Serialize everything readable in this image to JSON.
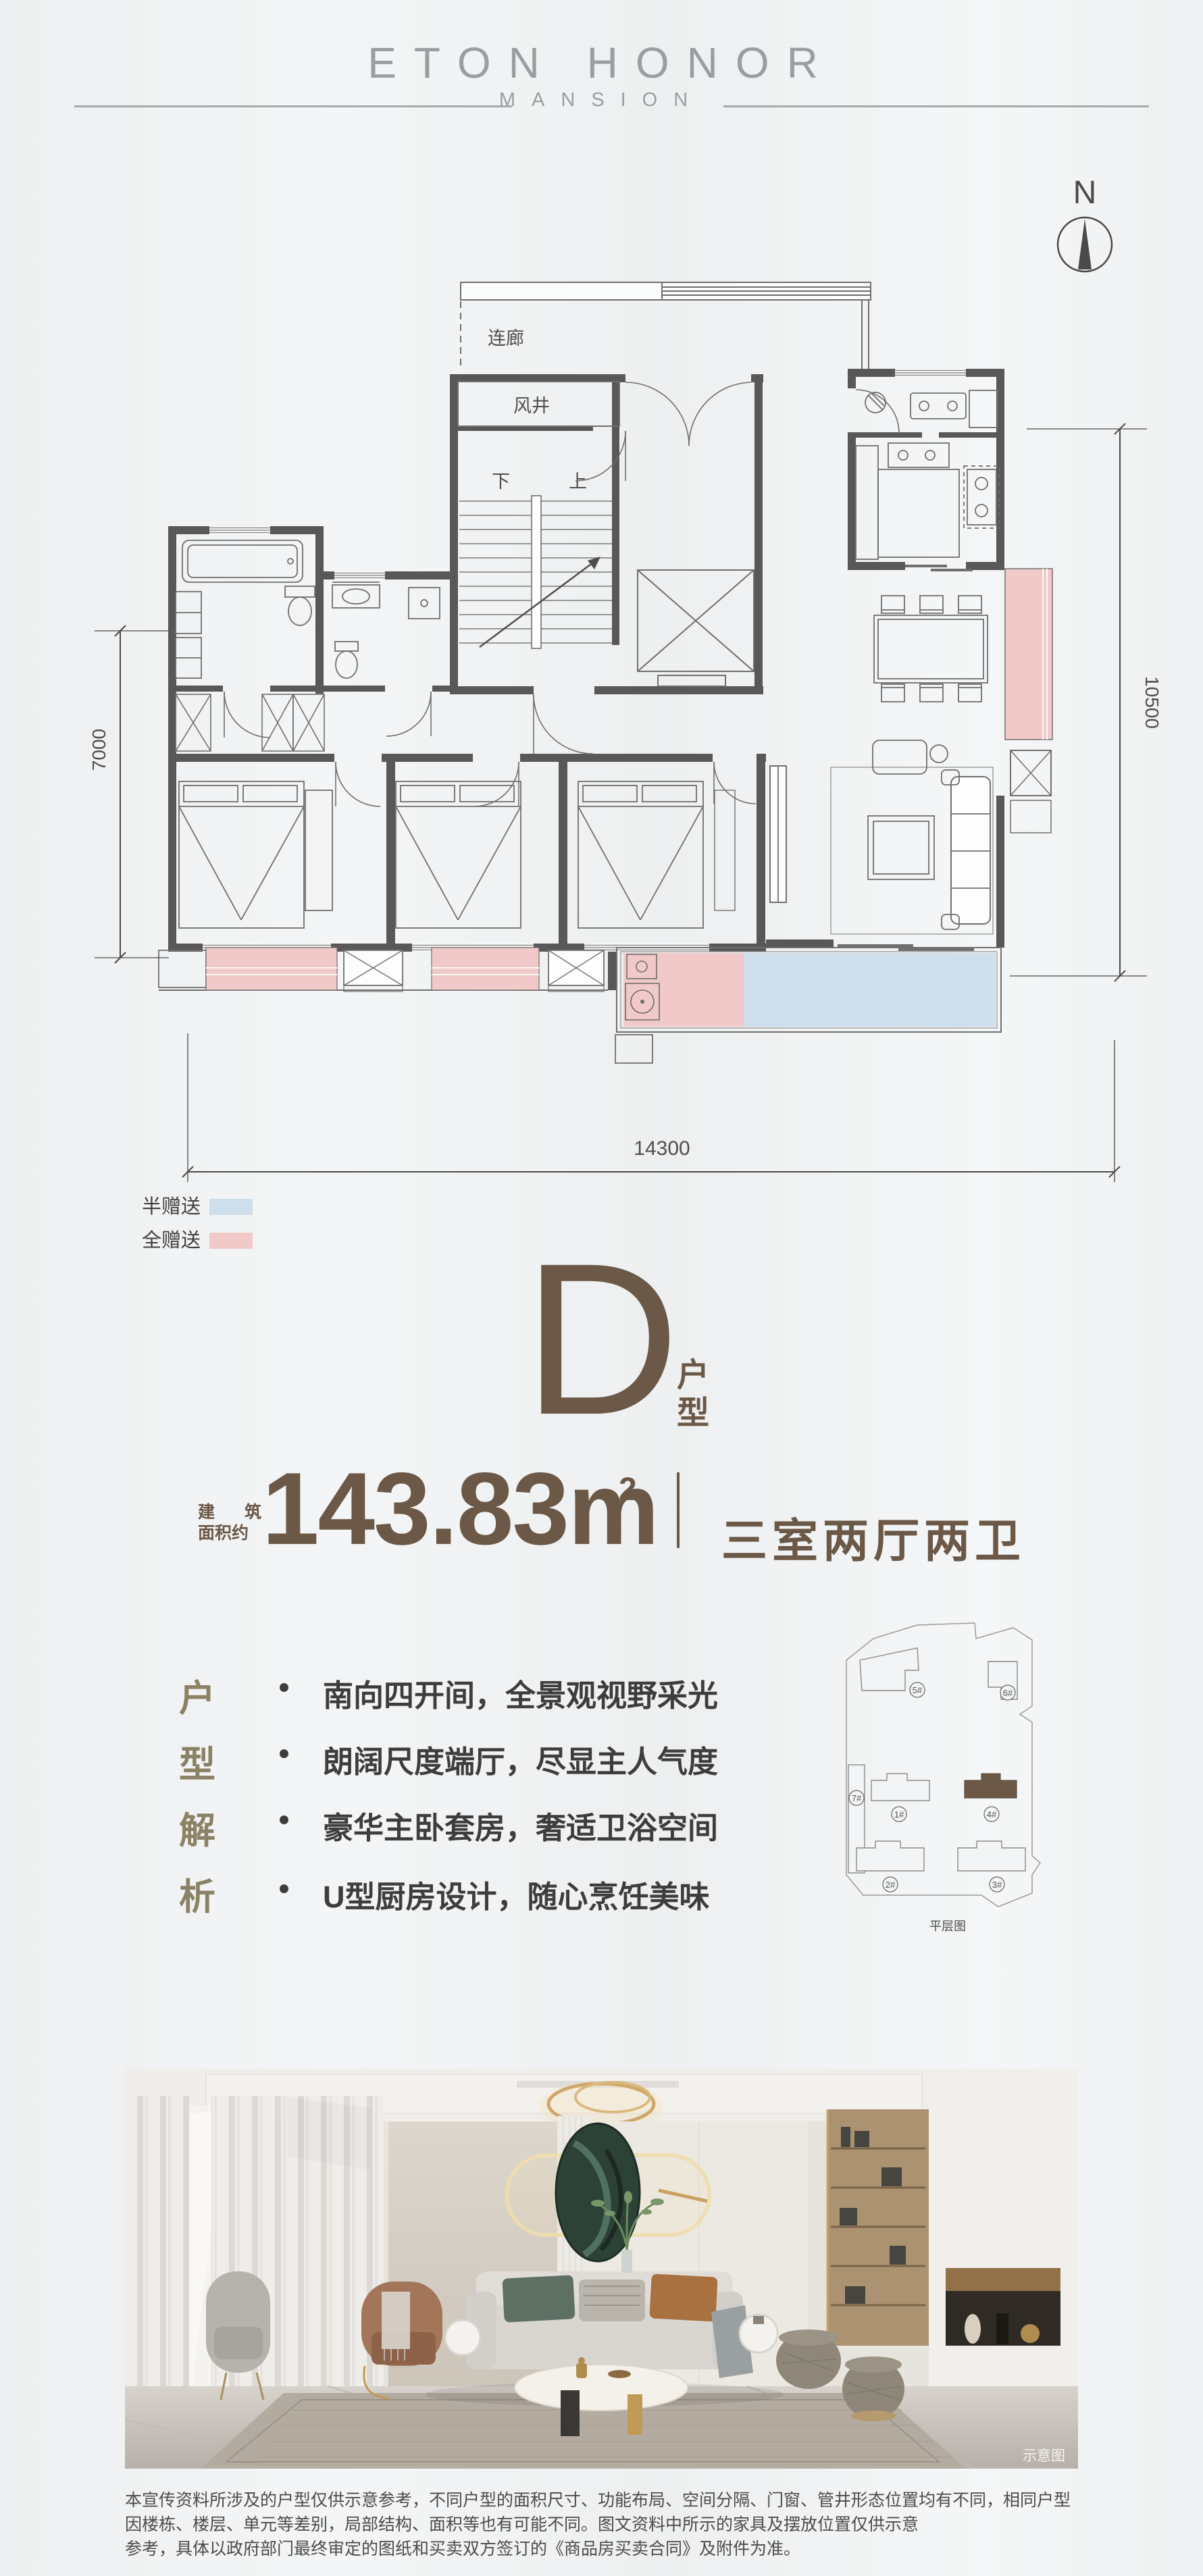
{
  "colors": {
    "background": "#eef0f2",
    "wall": "#595757",
    "accent_brown": "#6b5847",
    "accent_olive": "#8b8164",
    "half_gift_blue": "#cfdeeb",
    "full_gift_pink": "#f1c9c9",
    "header_gray": "#9b9da0"
  },
  "header": {
    "brand": "ETON HONOR",
    "sub": "MANSION"
  },
  "compass": {
    "label": "N"
  },
  "plan": {
    "labels": {
      "corridor": "连廊",
      "shaft": "风井",
      "down": "下",
      "up": "上"
    },
    "dims": {
      "left": "7000",
      "right": "10500",
      "bottom": "14300"
    }
  },
  "legend": {
    "items": [
      {
        "label": "半赠送",
        "color": "#cfdeeb"
      },
      {
        "label": "全赠送",
        "color": "#f1c9c9"
      }
    ]
  },
  "unit": {
    "letter": "D",
    "type_chars": [
      "户",
      "型"
    ],
    "area_prefix_chars": [
      "建",
      "筑"
    ],
    "area_prefix_line2": "面积约",
    "area_value": "143.83m",
    "area_sup": "2",
    "rooms": "三室两厅两卫"
  },
  "analysis": {
    "title_chars": [
      "户",
      "型",
      "解",
      "析"
    ],
    "bullets": [
      "南向四开间，全景观视野采光",
      "朗阔尺度端厅，尽显主人气度",
      "豪华主卧套房，奢适卫浴空间",
      "U型厨房设计，随心烹饪美味"
    ]
  },
  "siteplan": {
    "caption": "平层图",
    "buildings": [
      {
        "label": "5#"
      },
      {
        "label": "6#"
      },
      {
        "label": "7#"
      },
      {
        "label": "1#"
      },
      {
        "label": "4#"
      },
      {
        "label": "2#"
      },
      {
        "label": "3#"
      }
    ],
    "highlighted": "4#"
  },
  "photo": {
    "watermark": "示意图"
  },
  "disclaimer": {
    "line1": "本宣传资料所涉及的户型仅供示意参考，不同户型的面积尺寸、功能布局、空间分隔、门窗、管井形态位置均有不同，相同户型因楼栋、楼层、单元等差别，局部结构、面积等也有可能不同。图文资料中所示的家具及摆放位置仅供示意",
    "line2": "参考，具体以政府部门最终审定的图纸和买卖双方签订的《商品房买卖合同》及附件为准。"
  }
}
